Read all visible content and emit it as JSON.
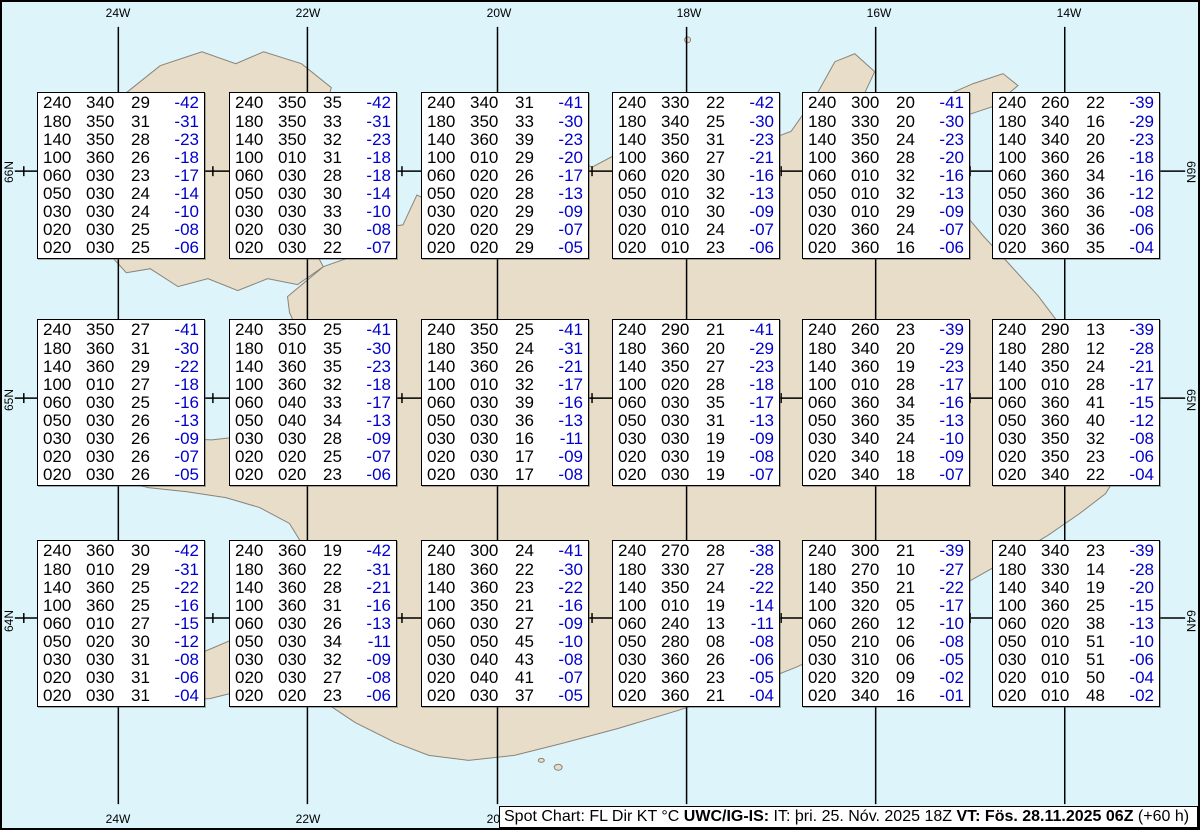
{
  "title": "Spot Chart: FL Dir KT °C",
  "colors": {
    "ocean": "#ddf4fb",
    "land": "#e7ddc8",
    "coastline": "#8a8378",
    "grid": "#000000",
    "temperature_text": "#0000cc",
    "value_text": "#000000",
    "box_background": "#ffffff"
  },
  "axis": {
    "top_labels": [
      "24W",
      "22W",
      "20W",
      "18W",
      "16W",
      "14W"
    ],
    "bottom_labels": [
      "24W",
      "22W",
      "20W"
    ],
    "left_labels": [
      "66N",
      "65N",
      "64N"
    ],
    "right_labels": [
      "66N",
      "65N",
      "64N"
    ]
  },
  "status_bar": {
    "prefix": "Spot Chart: FL Dir KT °C ",
    "source": "UWC/IG-IS:",
    "issued": " IT: þri. 25. Nóv. 2025 18Z ",
    "valid": "VT: Fös. 28.11.2025 06Z",
    "suffix": " (+60 h)"
  },
  "chart_data": {
    "type": "table",
    "title": "Spot Chart: FL Dir KT °C",
    "columns": [
      "FL",
      "Dir",
      "KT",
      "°C"
    ],
    "lon_gridlines": [
      "24W",
      "22W",
      "20W",
      "18W",
      "16W",
      "14W"
    ],
    "lat_gridlines": [
      "66N",
      "65N",
      "64N"
    ],
    "spots": [
      {
        "rows": [
          [
            "240",
            "340",
            "29",
            "-42"
          ],
          [
            "180",
            "350",
            "31",
            "-31"
          ],
          [
            "140",
            "350",
            "28",
            "-23"
          ],
          [
            "100",
            "360",
            "26",
            "-18"
          ],
          [
            "060",
            "030",
            "23",
            "-17"
          ],
          [
            "050",
            "030",
            "24",
            "-14"
          ],
          [
            "030",
            "030",
            "24",
            "-10"
          ],
          [
            "020",
            "030",
            "25",
            "-08"
          ],
          [
            "020",
            "030",
            "25",
            "-06"
          ]
        ]
      },
      {
        "rows": [
          [
            "240",
            "350",
            "35",
            "-42"
          ],
          [
            "180",
            "350",
            "33",
            "-31"
          ],
          [
            "140",
            "350",
            "32",
            "-23"
          ],
          [
            "100",
            "010",
            "31",
            "-18"
          ],
          [
            "060",
            "030",
            "28",
            "-18"
          ],
          [
            "050",
            "030",
            "30",
            "-14"
          ],
          [
            "030",
            "030",
            "33",
            "-10"
          ],
          [
            "020",
            "030",
            "30",
            "-08"
          ],
          [
            "020",
            "030",
            "22",
            "-07"
          ]
        ]
      },
      {
        "rows": [
          [
            "240",
            "340",
            "31",
            "-41"
          ],
          [
            "180",
            "350",
            "33",
            "-30"
          ],
          [
            "140",
            "360",
            "39",
            "-23"
          ],
          [
            "100",
            "010",
            "29",
            "-20"
          ],
          [
            "060",
            "020",
            "26",
            "-17"
          ],
          [
            "050",
            "020",
            "28",
            "-13"
          ],
          [
            "030",
            "020",
            "29",
            "-09"
          ],
          [
            "020",
            "020",
            "29",
            "-07"
          ],
          [
            "020",
            "020",
            "29",
            "-05"
          ]
        ]
      },
      {
        "rows": [
          [
            "240",
            "330",
            "22",
            "-42"
          ],
          [
            "180",
            "340",
            "25",
            "-30"
          ],
          [
            "140",
            "350",
            "31",
            "-23"
          ],
          [
            "100",
            "360",
            "27",
            "-21"
          ],
          [
            "060",
            "020",
            "30",
            "-16"
          ],
          [
            "050",
            "010",
            "32",
            "-13"
          ],
          [
            "030",
            "010",
            "30",
            "-09"
          ],
          [
            "020",
            "010",
            "24",
            "-07"
          ],
          [
            "020",
            "010",
            "23",
            "-06"
          ]
        ]
      },
      {
        "rows": [
          [
            "240",
            "300",
            "20",
            "-41"
          ],
          [
            "180",
            "330",
            "20",
            "-30"
          ],
          [
            "140",
            "350",
            "24",
            "-23"
          ],
          [
            "100",
            "360",
            "28",
            "-20"
          ],
          [
            "060",
            "010",
            "32",
            "-16"
          ],
          [
            "050",
            "010",
            "32",
            "-13"
          ],
          [
            "030",
            "010",
            "29",
            "-09"
          ],
          [
            "020",
            "360",
            "24",
            "-07"
          ],
          [
            "020",
            "360",
            "16",
            "-06"
          ]
        ]
      },
      {
        "rows": [
          [
            "240",
            "260",
            "22",
            "-39"
          ],
          [
            "180",
            "340",
            "16",
            "-29"
          ],
          [
            "140",
            "340",
            "20",
            "-23"
          ],
          [
            "100",
            "360",
            "26",
            "-18"
          ],
          [
            "060",
            "360",
            "34",
            "-16"
          ],
          [
            "050",
            "360",
            "36",
            "-12"
          ],
          [
            "030",
            "360",
            "36",
            "-08"
          ],
          [
            "020",
            "360",
            "36",
            "-06"
          ],
          [
            "020",
            "360",
            "35",
            "-04"
          ]
        ]
      },
      {
        "rows": [
          [
            "240",
            "350",
            "27",
            "-41"
          ],
          [
            "180",
            "360",
            "31",
            "-30"
          ],
          [
            "140",
            "360",
            "29",
            "-22"
          ],
          [
            "100",
            "010",
            "27",
            "-18"
          ],
          [
            "060",
            "030",
            "25",
            "-16"
          ],
          [
            "050",
            "030",
            "26",
            "-13"
          ],
          [
            "030",
            "030",
            "26",
            "-09"
          ],
          [
            "020",
            "030",
            "26",
            "-07"
          ],
          [
            "020",
            "030",
            "26",
            "-05"
          ]
        ]
      },
      {
        "rows": [
          [
            "240",
            "350",
            "25",
            "-41"
          ],
          [
            "180",
            "010",
            "35",
            "-30"
          ],
          [
            "140",
            "360",
            "35",
            "-23"
          ],
          [
            "100",
            "360",
            "32",
            "-18"
          ],
          [
            "060",
            "040",
            "33",
            "-17"
          ],
          [
            "050",
            "040",
            "34",
            "-13"
          ],
          [
            "030",
            "030",
            "28",
            "-09"
          ],
          [
            "020",
            "020",
            "25",
            "-07"
          ],
          [
            "020",
            "020",
            "23",
            "-06"
          ]
        ]
      },
      {
        "rows": [
          [
            "240",
            "350",
            "25",
            "-41"
          ],
          [
            "180",
            "350",
            "24",
            "-31"
          ],
          [
            "140",
            "360",
            "26",
            "-21"
          ],
          [
            "100",
            "010",
            "32",
            "-17"
          ],
          [
            "060",
            "030",
            "39",
            "-16"
          ],
          [
            "050",
            "030",
            "36",
            "-13"
          ],
          [
            "030",
            "030",
            "16",
            "-11"
          ],
          [
            "020",
            "030",
            "17",
            "-09"
          ],
          [
            "020",
            "030",
            "17",
            "-08"
          ]
        ]
      },
      {
        "rows": [
          [
            "240",
            "290",
            "21",
            "-41"
          ],
          [
            "180",
            "360",
            "20",
            "-29"
          ],
          [
            "140",
            "350",
            "27",
            "-23"
          ],
          [
            "100",
            "020",
            "28",
            "-18"
          ],
          [
            "060",
            "030",
            "35",
            "-17"
          ],
          [
            "050",
            "030",
            "31",
            "-13"
          ],
          [
            "030",
            "030",
            "19",
            "-09"
          ],
          [
            "020",
            "030",
            "19",
            "-08"
          ],
          [
            "020",
            "030",
            "19",
            "-07"
          ]
        ]
      },
      {
        "rows": [
          [
            "240",
            "260",
            "23",
            "-39"
          ],
          [
            "180",
            "340",
            "20",
            "-29"
          ],
          [
            "140",
            "360",
            "19",
            "-23"
          ],
          [
            "100",
            "010",
            "28",
            "-17"
          ],
          [
            "060",
            "360",
            "34",
            "-16"
          ],
          [
            "050",
            "360",
            "35",
            "-13"
          ],
          [
            "030",
            "340",
            "24",
            "-10"
          ],
          [
            "020",
            "340",
            "18",
            "-09"
          ],
          [
            "020",
            "340",
            "18",
            "-07"
          ]
        ]
      },
      {
        "rows": [
          [
            "240",
            "290",
            "13",
            "-39"
          ],
          [
            "180",
            "280",
            "12",
            "-28"
          ],
          [
            "140",
            "350",
            "24",
            "-21"
          ],
          [
            "100",
            "010",
            "28",
            "-17"
          ],
          [
            "060",
            "360",
            "41",
            "-15"
          ],
          [
            "050",
            "360",
            "40",
            "-12"
          ],
          [
            "030",
            "350",
            "32",
            "-08"
          ],
          [
            "020",
            "350",
            "23",
            "-06"
          ],
          [
            "020",
            "340",
            "22",
            "-04"
          ]
        ]
      },
      {
        "rows": [
          [
            "240",
            "360",
            "30",
            "-42"
          ],
          [
            "180",
            "010",
            "29",
            "-31"
          ],
          [
            "140",
            "360",
            "25",
            "-22"
          ],
          [
            "100",
            "360",
            "25",
            "-16"
          ],
          [
            "060",
            "010",
            "27",
            "-15"
          ],
          [
            "050",
            "020",
            "30",
            "-12"
          ],
          [
            "030",
            "030",
            "31",
            "-08"
          ],
          [
            "020",
            "030",
            "31",
            "-06"
          ],
          [
            "020",
            "030",
            "31",
            "-04"
          ]
        ]
      },
      {
        "rows": [
          [
            "240",
            "360",
            "19",
            "-42"
          ],
          [
            "180",
            "360",
            "22",
            "-31"
          ],
          [
            "140",
            "360",
            "28",
            "-21"
          ],
          [
            "100",
            "360",
            "31",
            "-16"
          ],
          [
            "060",
            "030",
            "26",
            "-13"
          ],
          [
            "050",
            "030",
            "34",
            "-11"
          ],
          [
            "030",
            "030",
            "32",
            "-09"
          ],
          [
            "020",
            "030",
            "27",
            "-08"
          ],
          [
            "020",
            "020",
            "23",
            "-06"
          ]
        ]
      },
      {
        "rows": [
          [
            "240",
            "300",
            "24",
            "-41"
          ],
          [
            "180",
            "360",
            "22",
            "-30"
          ],
          [
            "140",
            "360",
            "23",
            "-22"
          ],
          [
            "100",
            "350",
            "21",
            "-16"
          ],
          [
            "060",
            "030",
            "27",
            "-09"
          ],
          [
            "050",
            "050",
            "45",
            "-10"
          ],
          [
            "030",
            "040",
            "43",
            "-08"
          ],
          [
            "020",
            "040",
            "41",
            "-07"
          ],
          [
            "020",
            "030",
            "37",
            "-05"
          ]
        ]
      },
      {
        "rows": [
          [
            "240",
            "270",
            "28",
            "-38"
          ],
          [
            "180",
            "330",
            "27",
            "-28"
          ],
          [
            "140",
            "350",
            "24",
            "-22"
          ],
          [
            "100",
            "010",
            "19",
            "-14"
          ],
          [
            "060",
            "240",
            "13",
            "-11"
          ],
          [
            "050",
            "280",
            "08",
            "-08"
          ],
          [
            "030",
            "360",
            "26",
            "-06"
          ],
          [
            "020",
            "360",
            "23",
            "-05"
          ],
          [
            "020",
            "360",
            "21",
            "-04"
          ]
        ]
      },
      {
        "rows": [
          [
            "240",
            "300",
            "21",
            "-39"
          ],
          [
            "180",
            "270",
            "10",
            "-27"
          ],
          [
            "140",
            "350",
            "21",
            "-22"
          ],
          [
            "100",
            "320",
            "05",
            "-17"
          ],
          [
            "060",
            "260",
            "12",
            "-10"
          ],
          [
            "050",
            "210",
            "06",
            "-08"
          ],
          [
            "030",
            "310",
            "06",
            "-05"
          ],
          [
            "020",
            "320",
            "09",
            "-02"
          ],
          [
            "020",
            "340",
            "16",
            "-01"
          ]
        ]
      },
      {
        "rows": [
          [
            "240",
            "340",
            "23",
            "-39"
          ],
          [
            "180",
            "330",
            "14",
            "-28"
          ],
          [
            "140",
            "340",
            "19",
            "-20"
          ],
          [
            "100",
            "360",
            "25",
            "-15"
          ],
          [
            "060",
            "020",
            "38",
            "-13"
          ],
          [
            "050",
            "010",
            "51",
            "-10"
          ],
          [
            "030",
            "010",
            "51",
            "-06"
          ],
          [
            "020",
            "010",
            "50",
            "-04"
          ],
          [
            "020",
            "010",
            "48",
            "-02"
          ]
        ]
      }
    ]
  }
}
